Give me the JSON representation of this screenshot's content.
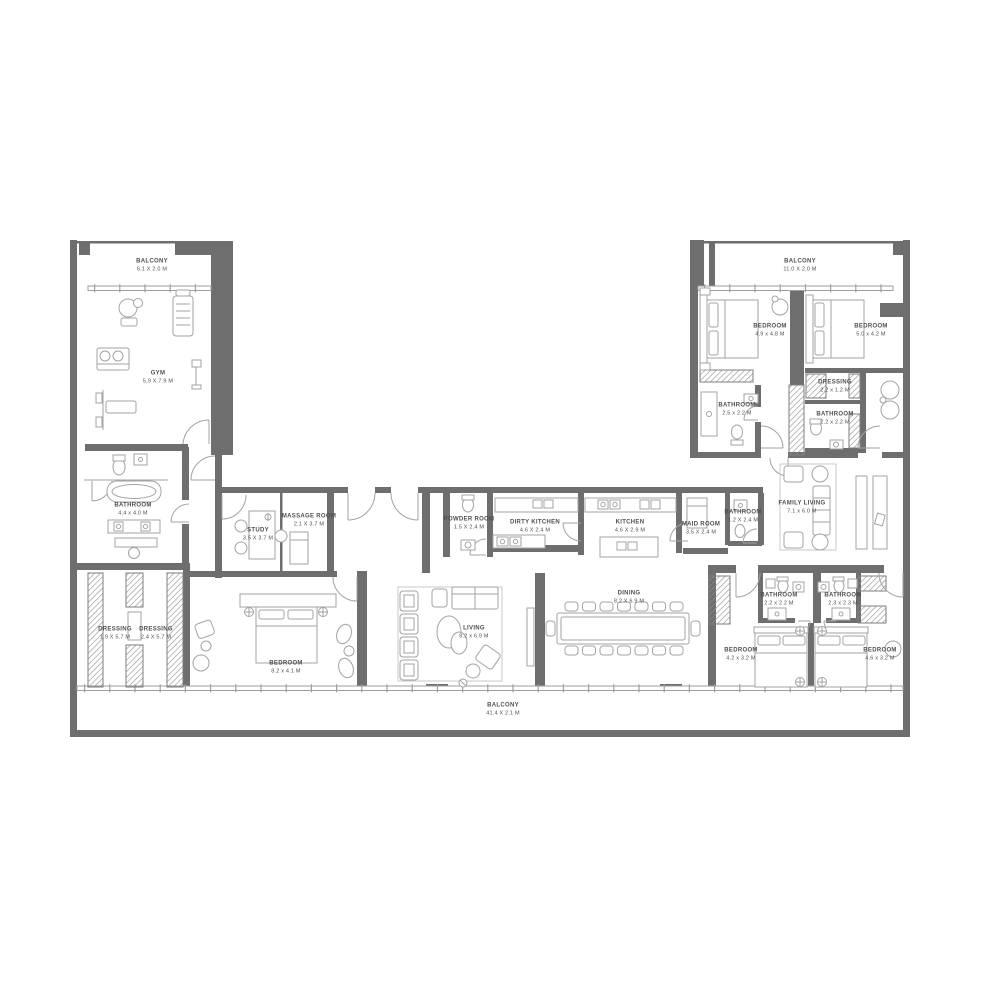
{
  "colors": {
    "wall": "#6e6e6e",
    "line": "#9e9e9e",
    "furniture": "#a3a3a3",
    "rug": "#c9c9c9",
    "label": "#4f4f4f",
    "background": "#ffffff",
    "hatch": "#8f8f8f"
  },
  "rooms": {
    "balcony_top_left": {
      "label": "BALCONY",
      "dims": "6.1 X 2.0 M"
    },
    "gym": {
      "label": "GYM",
      "dims": "5.9 X 7.9 M"
    },
    "bathroom_master": {
      "label": "BATHROOM",
      "dims": "4.4 x 4.0 M"
    },
    "dressing_left_1": {
      "label": "DRESSING",
      "dims": "1.9 X 5.7 M"
    },
    "dressing_left_2": {
      "label": "DRESSING",
      "dims": "2.4 X 5.7 M"
    },
    "study": {
      "label": "STUDY",
      "dims": "3.5 X 3.7 M"
    },
    "massage_room": {
      "label": "MASSAGE ROOM",
      "dims": "2.1 X 3.7 M"
    },
    "powder_room": {
      "label": "POWDER ROOM",
      "dims": "1.5 X 2.4 M"
    },
    "dirty_kitchen": {
      "label": "DIRTY KITCHEN",
      "dims": "4.6 X 2.4 M"
    },
    "kitchen": {
      "label": "KITCHEN",
      "dims": "4.6 X 2.9 M"
    },
    "maid_room": {
      "label": "MAID ROOM",
      "dims": "3.5 X 2.4 M"
    },
    "bathroom_maid": {
      "label": "BATHROOM",
      "dims": "1.2 X 2.4 M"
    },
    "family_living": {
      "label": "FAMILY LIVING",
      "dims": "7.1 x 6.0 M"
    },
    "balcony_top_right": {
      "label": "BALCONY",
      "dims": "11.0 X 2.0 M"
    },
    "bedroom_top_right_1": {
      "label": "BEDROOM",
      "dims": "4.9 x 4.8 M"
    },
    "bedroom_top_right_2": {
      "label": "BEDROOM",
      "dims": "5.0 x 4.2 M"
    },
    "bathroom_top_right_1": {
      "label": "BATHROOM",
      "dims": "2.5 x 2.2 M"
    },
    "dressing_top_right": {
      "label": "DRESSING",
      "dims": "2.2 x 1.2 M"
    },
    "bathroom_top_right_2": {
      "label": "BATHROOM",
      "dims": "2.2 x 2.2 M"
    },
    "bedroom_master": {
      "label": "BEDROOM",
      "dims": "8.2 x 4.1 M"
    },
    "living": {
      "label": "LIVING",
      "dims": "8.2 x 6.9 M"
    },
    "dining": {
      "label": "DINING",
      "dims": "8.2 X 6.9 M"
    },
    "bedroom_bottom_right_1": {
      "label": "BEDROOM",
      "dims": "4.2 x 3.2 M"
    },
    "bedroom_bottom_right_2": {
      "label": "BEDROOM",
      "dims": "4.6 x 3.2 M"
    },
    "bathroom_bottom_right_1": {
      "label": "BATHROOM",
      "dims": "2.2 x 2.2 M"
    },
    "bathroom_bottom_right_2": {
      "label": "BATHROOM",
      "dims": "2.3 x 2.3 M"
    },
    "balcony_bottom": {
      "label": "BALCONY",
      "dims": "41.4 X 2.1 M"
    }
  }
}
